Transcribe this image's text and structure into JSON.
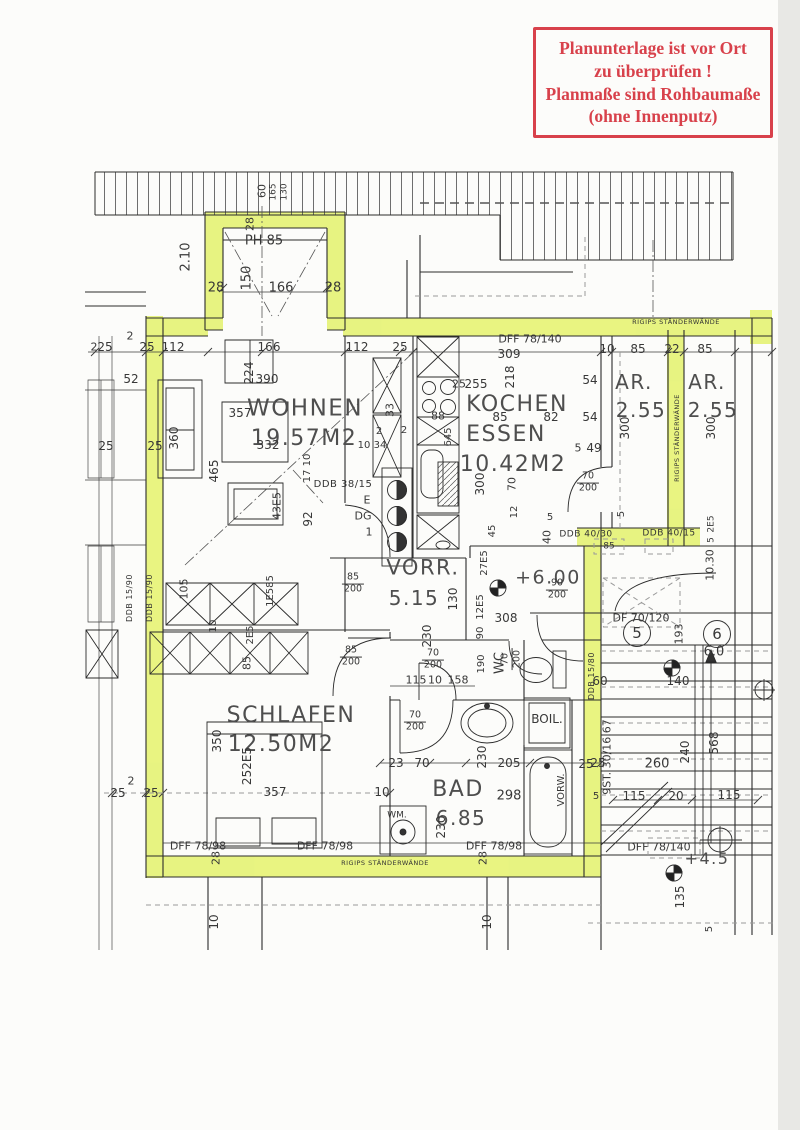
{
  "colors": {
    "highlight": "#e3f163",
    "stamp_red": "#d8414b",
    "ink": "#2b2b2b",
    "paper": "#fcfcfa",
    "gray": "#9a9a9a"
  },
  "stamp": {
    "lines": [
      "Planunterlage ist vor Ort",
      "zu überprüfen !",
      "Planmaße sind Rohbaumaße",
      "(ohne Innenputz)"
    ]
  },
  "plan": {
    "labels": [
      {
        "t": "28",
        "x": 250,
        "y": 224,
        "r": -90,
        "s": 11
      },
      {
        "t": "60",
        "x": 262,
        "y": 191,
        "r": -90,
        "s": 11
      },
      {
        "t": "165",
        "x": 274,
        "y": 192,
        "r": -90,
        "s": 9
      },
      {
        "t": "130",
        "x": 285,
        "y": 192,
        "r": -90,
        "s": 9
      },
      {
        "t": "2.10",
        "x": 186,
        "y": 257,
        "r": -90,
        "s": 13
      },
      {
        "t": "150",
        "x": 247,
        "y": 278,
        "r": -90,
        "s": 13
      },
      {
        "t": "PH 85",
        "x": 264,
        "y": 241,
        "s": 13
      },
      {
        "t": "28",
        "x": 216,
        "y": 288,
        "s": 13
      },
      {
        "t": "166",
        "x": 281,
        "y": 288,
        "s": 13
      },
      {
        "t": "28",
        "x": 333,
        "y": 288,
        "s": 13
      },
      {
        "t": "2",
        "x": 94,
        "y": 347,
        "s": 11
      },
      {
        "t": "25",
        "x": 105,
        "y": 347,
        "s": 12
      },
      {
        "t": "2",
        "x": 130,
        "y": 336,
        "s": 11
      },
      {
        "t": "25",
        "x": 147,
        "y": 347,
        "s": 12
      },
      {
        "t": "112",
        "x": 173,
        "y": 347,
        "s": 12
      },
      {
        "t": "166",
        "x": 269,
        "y": 347,
        "s": 12
      },
      {
        "t": "112",
        "x": 357,
        "y": 347,
        "s": 12
      },
      {
        "t": "25",
        "x": 400,
        "y": 347,
        "s": 12
      },
      {
        "t": "10",
        "x": 607,
        "y": 349,
        "s": 12
      },
      {
        "t": "85",
        "x": 638,
        "y": 349,
        "s": 12
      },
      {
        "t": "22",
        "x": 672,
        "y": 349,
        "s": 12
      },
      {
        "t": "85",
        "x": 705,
        "y": 349,
        "s": 12
      },
      {
        "t": "DFF 78/140",
        "x": 530,
        "y": 339,
        "s": 11
      },
      {
        "t": "309",
        "x": 509,
        "y": 354,
        "s": 12
      },
      {
        "t": "52",
        "x": 131,
        "y": 379,
        "s": 12
      },
      {
        "t": "224",
        "x": 249,
        "y": 373,
        "r": -90,
        "s": 12
      },
      {
        "t": "390",
        "x": 267,
        "y": 379,
        "s": 12
      },
      {
        "t": "WOHNEN",
        "x": 305,
        "y": 409,
        "s": 23,
        "k": "room"
      },
      {
        "t": "19.57M2",
        "x": 304,
        "y": 439,
        "s": 22,
        "k": "room"
      },
      {
        "t": "357",
        "x": 240,
        "y": 413,
        "s": 12
      },
      {
        "t": "332",
        "x": 268,
        "y": 445,
        "s": 12
      },
      {
        "t": "360",
        "x": 174,
        "y": 438,
        "r": -90,
        "s": 12
      },
      {
        "t": "25",
        "x": 106,
        "y": 446,
        "s": 12
      },
      {
        "t": "25",
        "x": 155,
        "y": 446,
        "s": 12
      },
      {
        "t": "465",
        "x": 214,
        "y": 471,
        "r": -90,
        "s": 12
      },
      {
        "t": "43E5",
        "x": 277,
        "y": 506,
        "r": -90,
        "s": 11
      },
      {
        "t": "92",
        "x": 308,
        "y": 519,
        "r": -90,
        "s": 12
      },
      {
        "t": "17 10",
        "x": 308,
        "y": 468,
        "r": -90,
        "s": 10
      },
      {
        "t": "DDB 38/15",
        "x": 343,
        "y": 485,
        "s": 10,
        "k": "wall"
      },
      {
        "t": "33",
        "x": 390,
        "y": 410,
        "r": -90,
        "s": 11
      },
      {
        "t": "2",
        "x": 379,
        "y": 432,
        "s": 10
      },
      {
        "t": "2",
        "x": 404,
        "y": 431,
        "s": 10
      },
      {
        "t": "10",
        "x": 364,
        "y": 446,
        "s": 10
      },
      {
        "t": "34",
        "x": 380,
        "y": 446,
        "s": 10
      },
      {
        "t": "88",
        "x": 438,
        "y": 416,
        "s": 11
      },
      {
        "t": "645",
        "x": 449,
        "y": 437,
        "r": -90,
        "s": 10
      },
      {
        "t": "25",
        "x": 459,
        "y": 384,
        "s": 11
      },
      {
        "t": "255",
        "x": 476,
        "y": 384,
        "s": 12
      },
      {
        "t": "218",
        "x": 510,
        "y": 377,
        "r": -90,
        "s": 12
      },
      {
        "t": "KOCHEN",
        "x": 517,
        "y": 405,
        "s": 22,
        "k": "room"
      },
      {
        "t": "ESSEN",
        "x": 506,
        "y": 435,
        "s": 22,
        "k": "room"
      },
      {
        "t": "10.42M2",
        "x": 513,
        "y": 465,
        "s": 22,
        "k": "room"
      },
      {
        "t": "85",
        "x": 500,
        "y": 417,
        "s": 12
      },
      {
        "t": "82",
        "x": 551,
        "y": 417,
        "s": 12
      },
      {
        "t": "54",
        "x": 590,
        "y": 380,
        "s": 12
      },
      {
        "t": "54",
        "x": 590,
        "y": 417,
        "s": 12
      },
      {
        "t": "5",
        "x": 578,
        "y": 448,
        "s": 11
      },
      {
        "t": "49",
        "x": 594,
        "y": 448,
        "s": 12
      },
      {
        "t": "300",
        "x": 480,
        "y": 484,
        "r": -90,
        "s": 12
      },
      {
        "t": "70",
        "x": 512,
        "y": 484,
        "r": -90,
        "s": 11
      },
      {
        "t": "AR.",
        "x": 634,
        "y": 382,
        "s": 20,
        "k": "room"
      },
      {
        "t": "2.55",
        "x": 641,
        "y": 410,
        "s": 20,
        "k": "room"
      },
      {
        "t": "AR.",
        "x": 707,
        "y": 382,
        "s": 20,
        "k": "room"
      },
      {
        "t": "2.55",
        "x": 713,
        "y": 410,
        "s": 20,
        "k": "room"
      },
      {
        "t": "300",
        "x": 625,
        "y": 428,
        "r": -90,
        "s": 12
      },
      {
        "t": "300",
        "x": 711,
        "y": 428,
        "r": -90,
        "s": 12
      },
      {
        "t": "RIGIPS STÄNDERWÄNDE",
        "x": 676,
        "y": 322,
        "s": 6.5,
        "k": "wall"
      },
      {
        "t": "RIGIPS STÄNDERWÄNDE",
        "x": 677,
        "y": 438,
        "r": -90,
        "s": 6.5,
        "k": "wall"
      },
      {
        "t": "5",
        "x": 622,
        "y": 514,
        "r": -90,
        "s": 10
      },
      {
        "t": "2E5",
        "x": 712,
        "y": 524,
        "r": -90,
        "s": 9
      },
      {
        "t": "5",
        "x": 712,
        "y": 540,
        "r": -90,
        "s": 9
      },
      {
        "t": "10.30",
        "x": 710,
        "y": 565,
        "r": -90,
        "s": 11
      },
      {
        "t": "DDB 40/30",
        "x": 586,
        "y": 535,
        "s": 9,
        "k": "wall"
      },
      {
        "t": "DDB 40/15",
        "x": 669,
        "y": 534,
        "s": 9,
        "k": "wall"
      },
      {
        "t": "85",
        "x": 609,
        "y": 547,
        "s": 9
      },
      {
        "t": "40",
        "x": 547,
        "y": 537,
        "r": -90,
        "s": 11
      },
      {
        "t": "5",
        "x": 550,
        "y": 518,
        "s": 10
      },
      {
        "t": "E",
        "x": 367,
        "y": 500,
        "s": 11
      },
      {
        "t": "DG",
        "x": 363,
        "y": 516,
        "s": 11
      },
      {
        "t": "1",
        "x": 369,
        "y": 532,
        "s": 11
      },
      {
        "t": "VORR.",
        "x": 423,
        "y": 568,
        "s": 21,
        "k": "room"
      },
      {
        "t": "5.15",
        "x": 414,
        "y": 598,
        "s": 20,
        "k": "room"
      },
      {
        "t": "130",
        "x": 453,
        "y": 599,
        "r": -90,
        "s": 12
      },
      {
        "t": "27E5",
        "x": 485,
        "y": 563,
        "r": -90,
        "s": 10
      },
      {
        "t": "45",
        "x": 493,
        "y": 531,
        "r": -90,
        "s": 10
      },
      {
        "t": "12",
        "x": 515,
        "y": 512,
        "r": -90,
        "s": 10
      },
      {
        "t": "12E5",
        "x": 481,
        "y": 607,
        "r": -90,
        "s": 10
      },
      {
        "t": "90",
        "x": 481,
        "y": 633,
        "r": -90,
        "s": 10
      },
      {
        "t": "190",
        "x": 482,
        "y": 664,
        "r": -90,
        "s": 10
      },
      {
        "t": "308",
        "x": 506,
        "y": 618,
        "s": 12
      },
      {
        "t": "230",
        "x": 427,
        "y": 636,
        "r": -90,
        "s": 12
      },
      {
        "t": "+6.00",
        "x": 548,
        "y": 578,
        "s": 19,
        "k": "room"
      },
      {
        "t": "115",
        "x": 416,
        "y": 680,
        "s": 11
      },
      {
        "t": "10",
        "x": 435,
        "y": 680,
        "s": 11
      },
      {
        "t": "158",
        "x": 458,
        "y": 680,
        "s": 11
      },
      {
        "t": "85/200",
        "x": 353,
        "y": 584,
        "k": "frac"
      },
      {
        "t": "85/200",
        "x": 351,
        "y": 657,
        "k": "frac"
      },
      {
        "t": "70/200",
        "x": 433,
        "y": 660,
        "k": "frac"
      },
      {
        "t": "70/200",
        "x": 512,
        "y": 659,
        "r": -90,
        "k": "frac"
      },
      {
        "t": "70/200",
        "x": 588,
        "y": 483,
        "k": "frac"
      },
      {
        "t": "90/200",
        "x": 557,
        "y": 590,
        "k": "frac"
      },
      {
        "t": "70/200",
        "x": 415,
        "y": 722,
        "k": "frac"
      },
      {
        "t": "WC",
        "x": 500,
        "y": 663,
        "r": -90,
        "s": 13
      },
      {
        "t": "BOIL.",
        "x": 547,
        "y": 719,
        "s": 12
      },
      {
        "t": "BAD",
        "x": 458,
        "y": 790,
        "s": 22,
        "k": "room"
      },
      {
        "t": "6.85",
        "x": 461,
        "y": 818,
        "s": 20,
        "k": "room"
      },
      {
        "t": "230",
        "x": 482,
        "y": 757,
        "r": -90,
        "s": 12
      },
      {
        "t": "205",
        "x": 509,
        "y": 763,
        "s": 12
      },
      {
        "t": "25",
        "x": 598,
        "y": 763,
        "s": 12
      },
      {
        "t": "298",
        "x": 509,
        "y": 796,
        "s": 13
      },
      {
        "t": "23",
        "x": 396,
        "y": 763,
        "s": 12
      },
      {
        "t": "70",
        "x": 422,
        "y": 763,
        "s": 12
      },
      {
        "t": "VORW.",
        "x": 562,
        "y": 790,
        "r": -90,
        "s": 10
      },
      {
        "t": "WM.",
        "x": 397,
        "y": 816,
        "s": 9
      },
      {
        "t": "230",
        "x": 441,
        "y": 827,
        "r": -90,
        "s": 12
      },
      {
        "t": "SCHLAFEN",
        "x": 291,
        "y": 716,
        "s": 22,
        "k": "room"
      },
      {
        "t": "12.50M2",
        "x": 281,
        "y": 745,
        "s": 22,
        "k": "room"
      },
      {
        "t": "350",
        "x": 217,
        "y": 741,
        "r": -90,
        "s": 12
      },
      {
        "t": "252E5",
        "x": 247,
        "y": 766,
        "r": -90,
        "s": 12
      },
      {
        "t": "357",
        "x": 275,
        "y": 792,
        "s": 12
      },
      {
        "t": "10",
        "x": 382,
        "y": 792,
        "s": 12
      },
      {
        "t": "2",
        "x": 131,
        "y": 781,
        "s": 11
      },
      {
        "t": "25",
        "x": 118,
        "y": 793,
        "s": 12
      },
      {
        "t": "25",
        "x": 151,
        "y": 793,
        "s": 12
      },
      {
        "t": "105",
        "x": 184,
        "y": 589,
        "r": -90,
        "s": 11
      },
      {
        "t": "1E585",
        "x": 271,
        "y": 591,
        "r": -90,
        "s": 10
      },
      {
        "t": "10",
        "x": 214,
        "y": 626,
        "r": -90,
        "s": 10
      },
      {
        "t": "2E5",
        "x": 251,
        "y": 635,
        "r": -90,
        "s": 10
      },
      {
        "t": "85",
        "x": 247,
        "y": 663,
        "r": -90,
        "s": 11
      },
      {
        "t": "DDB 15/90",
        "x": 130,
        "y": 598,
        "r": -90,
        "s": 8,
        "k": "wall"
      },
      {
        "t": "DDB 15/90",
        "x": 150,
        "y": 598,
        "r": -90,
        "s": 8,
        "k": "wall"
      },
      {
        "t": "DFF 78/98",
        "x": 198,
        "y": 846,
        "s": 11
      },
      {
        "t": "DFF 78/98",
        "x": 325,
        "y": 846,
        "s": 11
      },
      {
        "t": "DFF 78/98",
        "x": 494,
        "y": 846,
        "s": 11
      },
      {
        "t": "RIGIPS STÄNDERWÄNDE",
        "x": 385,
        "y": 863,
        "s": 6.5,
        "k": "wall"
      },
      {
        "t": "28",
        "x": 216,
        "y": 858,
        "r": -90,
        "s": 11
      },
      {
        "t": "28",
        "x": 483,
        "y": 858,
        "r": -90,
        "s": 11
      },
      {
        "t": "10",
        "x": 214,
        "y": 922,
        "r": -90,
        "s": 12
      },
      {
        "t": "10",
        "x": 487,
        "y": 922,
        "r": -90,
        "s": 12
      },
      {
        "t": "DDB 15/80",
        "x": 592,
        "y": 676,
        "r": -90,
        "s": 8,
        "k": "wall"
      },
      {
        "t": "DF 70/120",
        "x": 641,
        "y": 618,
        "s": 11
      },
      {
        "t": "5",
        "x": 637,
        "y": 633,
        "s": 15,
        "k": "circ"
      },
      {
        "t": "6",
        "x": 717,
        "y": 634,
        "s": 15,
        "k": "circ"
      },
      {
        "t": "193",
        "x": 679,
        "y": 634,
        "r": -90,
        "s": 11
      },
      {
        "t": "6.0",
        "x": 714,
        "y": 652,
        "s": 13
      },
      {
        "t": "140",
        "x": 678,
        "y": 681,
        "s": 12
      },
      {
        "t": "60",
        "x": 600,
        "y": 681,
        "s": 12
      },
      {
        "t": "9ST. 30/16.67",
        "x": 607,
        "y": 757,
        "r": -90,
        "s": 11
      },
      {
        "t": "25",
        "x": 586,
        "y": 764,
        "s": 12
      },
      {
        "t": "260",
        "x": 657,
        "y": 764,
        "s": 13
      },
      {
        "t": "240",
        "x": 685,
        "y": 752,
        "r": -90,
        "s": 12
      },
      {
        "t": "568",
        "x": 714,
        "y": 743,
        "r": -90,
        "s": 12
      },
      {
        "t": "115",
        "x": 634,
        "y": 796,
        "s": 12
      },
      {
        "t": "20",
        "x": 676,
        "y": 796,
        "s": 12
      },
      {
        "t": "115",
        "x": 729,
        "y": 795,
        "s": 12
      },
      {
        "t": "5",
        "x": 596,
        "y": 797,
        "s": 10
      },
      {
        "t": "DFF 78/140",
        "x": 659,
        "y": 847,
        "s": 11
      },
      {
        "t": "+4.5",
        "x": 707,
        "y": 859,
        "s": 16,
        "k": "room"
      },
      {
        "t": "135",
        "x": 680,
        "y": 897,
        "r": -90,
        "s": 12
      },
      {
        "t": "5",
        "x": 710,
        "y": 929,
        "r": -90,
        "s": 10
      }
    ]
  }
}
